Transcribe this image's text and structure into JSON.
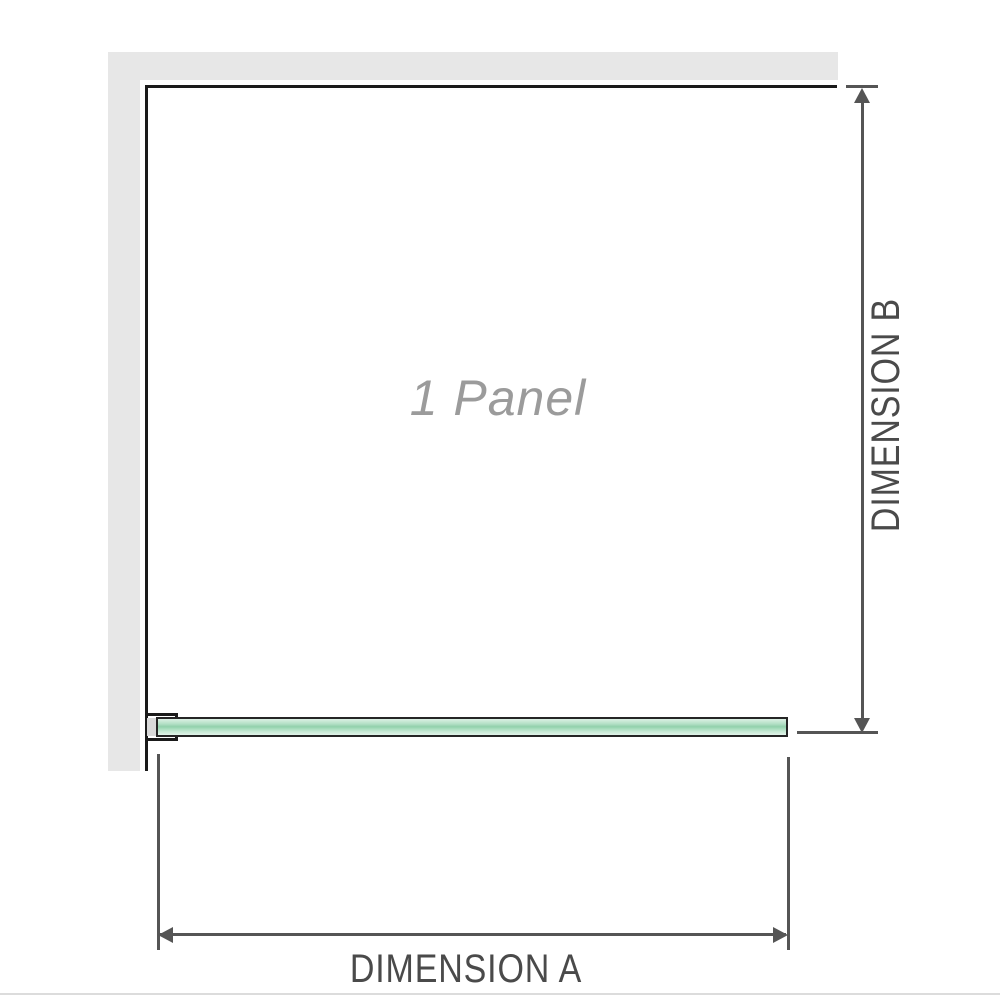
{
  "diagram": {
    "panel_label": "1 Panel",
    "dimension_a_label": "DIMENSION A",
    "dimension_b_label": "DIMENSION B"
  },
  "colors": {
    "wall_gray": "#e7e7e7",
    "outline_black": "#1a1a1a",
    "dimension_gray": "#555555",
    "label_gray": "#4a4a4a",
    "panel_label_gray": "#9b9b9b",
    "glass_border": "#252525",
    "glass_light": "#dcf0e4",
    "glass_mid": "#92d0ac",
    "bracket_fill": "#d9d9d9",
    "divider_gray": "#dcdcdc"
  }
}
